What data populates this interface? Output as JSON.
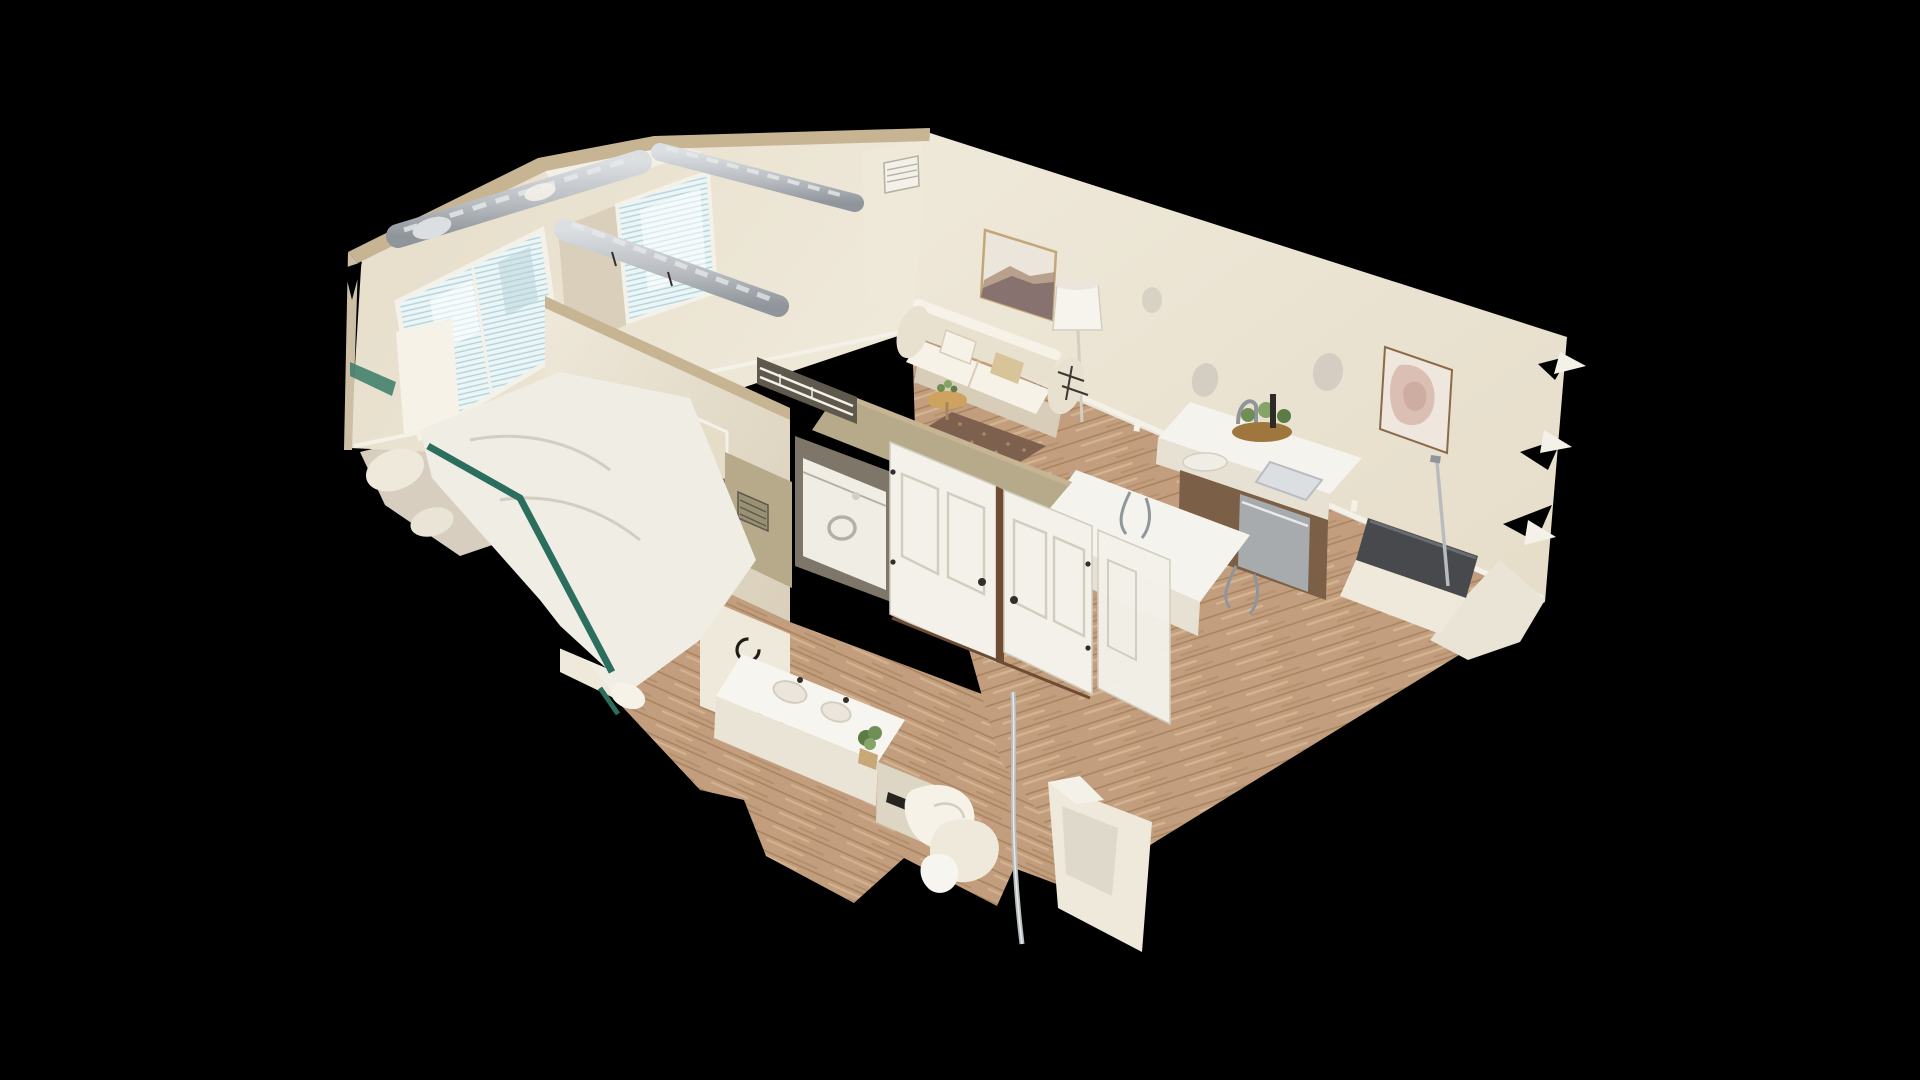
{
  "app": {
    "view_mode": "dollhouse-3d",
    "scene_description": "Top-down cutaway 3D scan of a one/two-bedroom apartment floating on a black background: bedroom with blinded window and teal bed frame (left), second bedroom seen through doorway (tan blanket, green frame), central hallway with white panel doors, stacked laundry, bathroom vanity with plant and towel rings, living room with cream sofa, landscape wall art and drum lamp, kitchen island with faucet, cacti centerpiece and brown cabinets, pink abstract art on right wall, silver HVAC ducts along cut wall tops, ragged scan edges"
  },
  "canvas": {
    "width": 1920,
    "height": 1080,
    "background": "#000000"
  },
  "palette": {
    "bg": "#000000",
    "wall_bright": "#efe9da",
    "wall_mid": "#e6ddc9",
    "wall_shade": "#d9cfba",
    "wall_dark": "#cdbfa5",
    "khaki": "#b6aa8a",
    "khaki_dark": "#9a9074",
    "cut_tan": "#c7b493",
    "trim_white": "#f4f1e8",
    "duct_light": "#dcdfe2",
    "duct_mid": "#b9bdc2",
    "duct_dark": "#8f959b",
    "window_lite": "#eaf6f8",
    "window_line": "#b7d2d8",
    "window_bright": "#ffffff",
    "carpet": "#d8cec0",
    "carpet_dark": "#cfc5b6",
    "wood": "#c29e7e",
    "wood_dark": "#a8845f",
    "wood_light": "#d6b794",
    "sofa": "#e9e1d0",
    "sofa_shade": "#d8cdb8",
    "pillow_white": "#f6f2e7",
    "pillow_tan": "#d9c49a",
    "art_canvas": "#ece5dc",
    "art_mtn": "#7e6a6a",
    "art_sand": "#ab9078",
    "frame_gold": "#c2a878",
    "art2_bg": "#efe7dd",
    "art2_pink": "#dcbfb4",
    "art2_pink_deep": "#c9a89e",
    "frame_brown": "#8a6a4a",
    "lamp": "#f7f4ed",
    "rug": "#7d604e",
    "rug_spot": "#a9886d",
    "table_wood": "#cda35f",
    "counter": "#f5f3ed",
    "counter_side": "#e7e1d3",
    "cab_brown": "#7b5f47",
    "steel": "#a7abae",
    "tray": "#a0763f",
    "plant": "#6f8f55",
    "plant_dark": "#5d7b47",
    "plant_light": "#86a468",
    "grinder": "#2e2a26",
    "teal": "#2c6e5e",
    "teal_bright": "#3a7a68",
    "blanket_tan": "#d9b369",
    "green_frame": "#2c6b50",
    "door_white": "#f3f1ea",
    "door_panel": "#d2cdbe",
    "gap_brown": "#6e4c34",
    "knob_dark": "#332e29",
    "alcove": "#7e7668",
    "closet_dark": "#5f584c",
    "appliance": "#f0ede5",
    "appliance_line": "#b5b0a4",
    "bath_frag": "#efe9dc",
    "ring_black": "#201d19",
    "vanity": "#f7f5ef",
    "vanity_side": "#e9e4d6",
    "cab_light": "#ddd6c4",
    "slot_dark": "#27231f",
    "pot_tan": "#c9a878",
    "chrome": "#b9bcbe",
    "chrome_hi": "#e8eaeb",
    "chair_dark": "#47494c",
    "chair_hi": "#6a6d70",
    "scan_hole": "#ccc5bb",
    "shadow_soft": "#d3cec2",
    "metal_decor": "#3a3632"
  },
  "scene": {
    "rooms": [
      {
        "id": "bedroom-primary",
        "features": [
          "window-with-blinds",
          "bed-white-linens",
          "teal-bed-frame"
        ]
      },
      {
        "id": "bedroom-secondary",
        "features": [
          "doorway-view",
          "tan-blanket-bed",
          "green-bed-frame"
        ]
      },
      {
        "id": "hallway",
        "features": [
          "white-panel-doors",
          "washer-dryer",
          "closet-wire-shelving",
          "wall-vents"
        ]
      },
      {
        "id": "bathroom",
        "features": [
          "vanity-counter",
          "potted-plant",
          "towel-rings",
          "toilet-fragments",
          "shower-pole"
        ]
      },
      {
        "id": "living-room",
        "features": [
          "cream-sofa",
          "landscape-art",
          "drum-lamp",
          "side-table",
          "brown-rug"
        ]
      },
      {
        "id": "kitchen",
        "features": [
          "white-island",
          "faucet",
          "cacti-centerpiece",
          "brown-cabinets",
          "dishwasher",
          "bar-stools",
          "pink-abstract-art"
        ]
      }
    ],
    "artifacts": [
      "silver-hvac-ducts",
      "ragged-scan-edges",
      "scan-holes-on-walls",
      "dark-office-chair-fragment"
    ]
  }
}
